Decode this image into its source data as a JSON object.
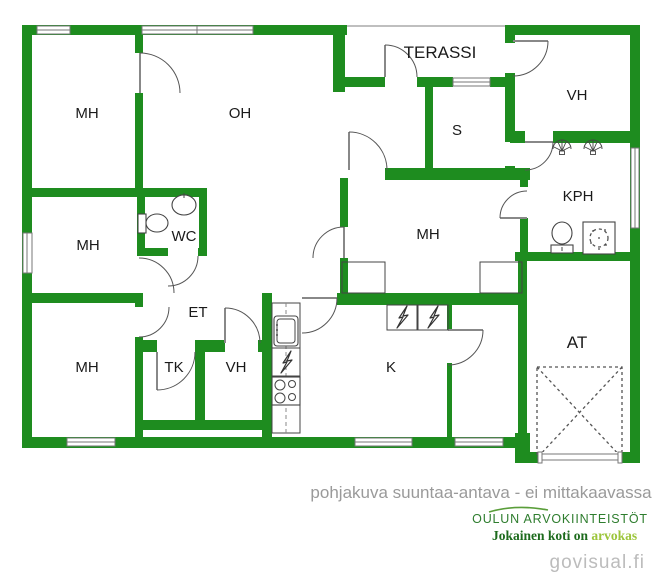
{
  "document": {
    "type": "floor-plan",
    "disclaimer": "pohjakuva suuntaa-antava - ei mittakaavassa",
    "watermark": "govisual.fi"
  },
  "branding": {
    "company": "OULUN ARVOKIINTEISTÖT",
    "slogan_dark": "Jokainen koti on ",
    "slogan_accent": "arvokas"
  },
  "colors": {
    "wall_green": "#1e8c1f",
    "label_text": "#1a1a1a",
    "disclaimer_gray": "#9a9a9a",
    "company_green": "#2e7d2e",
    "slogan_dark_green": "#1d6b1d",
    "slogan_light_green": "#9cc53a",
    "watermark_gray": "#bcbcbc"
  },
  "rooms": [
    {
      "id": "mh-top-left",
      "label": "MH"
    },
    {
      "id": "oh",
      "label": "OH"
    },
    {
      "id": "terassi",
      "label": "TERASSI"
    },
    {
      "id": "vh-top-right",
      "label": "VH"
    },
    {
      "id": "sauna",
      "label": "S"
    },
    {
      "id": "mh-mid-left",
      "label": "MH"
    },
    {
      "id": "wc",
      "label": "WC"
    },
    {
      "id": "kph",
      "label": "KPH"
    },
    {
      "id": "mh-center",
      "label": "MH"
    },
    {
      "id": "et",
      "label": "ET"
    },
    {
      "id": "mh-bottom-left",
      "label": "MH"
    },
    {
      "id": "tk",
      "label": "TK"
    },
    {
      "id": "vh-bottom",
      "label": "VH"
    },
    {
      "id": "k",
      "label": "K"
    },
    {
      "id": "at",
      "label": "AT"
    }
  ],
  "fixtures": [
    "toilet-icon",
    "sink-icon",
    "shower-head-icon",
    "shower-head-icon",
    "toilet-icon",
    "floor-drain-icon",
    "kitchen-sink-icon",
    "dishwasher-icon",
    "stove-icon",
    "appliance-icon",
    "appliance-icon",
    "car-space-marking",
    "garage-door",
    "window",
    "door-arc"
  ]
}
